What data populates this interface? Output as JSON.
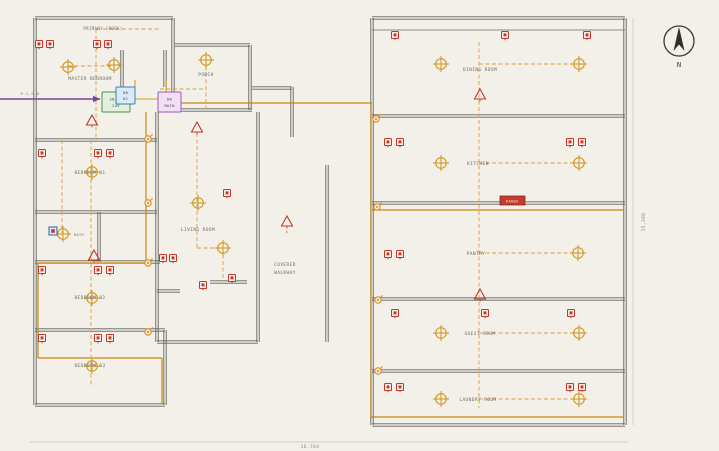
{
  "colors": {
    "background": "#f3f0ea",
    "wall": "#62615a",
    "thin_line": "#6a695f",
    "label": "#6f6e64",
    "dim": "#8a887f",
    "orange": "#c8860d",
    "orange_dash": "#d8a13a",
    "light": "#d39a26",
    "red": "#c0392b",
    "purple": "#8040a0",
    "yellow_conn": "#c8a415",
    "compass": "#3a3a35"
  },
  "room_labels": [
    {
      "text": "PRIMARY (ROOF)",
      "x": 103,
      "y": 30,
      "size": 4
    },
    {
      "text": "MASTER BEDROOM",
      "x": 90,
      "y": 80,
      "size": 4.5
    },
    {
      "text": "PORCH",
      "x": 206,
      "y": 76,
      "size": 4.5
    },
    {
      "text": "BEDROOM 01",
      "x": 90,
      "y": 174,
      "size": 4.5
    },
    {
      "text": "BATH",
      "x": 79,
      "y": 236,
      "size": 3.5
    },
    {
      "text": "BEDROOM 02",
      "x": 90,
      "y": 299,
      "size": 4.5
    },
    {
      "text": "BEDROOM 03",
      "x": 90,
      "y": 367,
      "size": 4.5
    },
    {
      "text": "LIVING ROOM",
      "x": 198,
      "y": 231,
      "size": 4.5
    },
    {
      "text": "COVERED",
      "x": 285,
      "y": 266,
      "size": 4.5
    },
    {
      "text": "WALKWAY",
      "x": 285,
      "y": 274,
      "size": 4.5
    },
    {
      "text": "DINING ROOM",
      "x": 480,
      "y": 71,
      "size": 4.5
    },
    {
      "text": "KITCHEN",
      "x": 478,
      "y": 165,
      "size": 4.5
    },
    {
      "text": "PANTRY",
      "x": 476,
      "y": 255,
      "size": 4.5
    },
    {
      "text": "GUEST ROOM",
      "x": 480,
      "y": 335,
      "size": 4.5
    },
    {
      "text": "LAUNDRY ROOM",
      "x": 478,
      "y": 401,
      "size": 4.5
    }
  ],
  "service_label": {
    "text": "M.S.E.B",
    "x": 30,
    "y": 95,
    "size": 3.8
  },
  "walls": [
    [
      35,
      18,
      173,
      18
    ],
    [
      35,
      18,
      35,
      405
    ],
    [
      173,
      18,
      173,
      112
    ],
    [
      122,
      50,
      122,
      87
    ],
    [
      165,
      50,
      165,
      87
    ],
    [
      175,
      45,
      250,
      45
    ],
    [
      250,
      45,
      250,
      110
    ],
    [
      175,
      110,
      252,
      110
    ],
    [
      35,
      140,
      157,
      140
    ],
    [
      157,
      112,
      157,
      342
    ],
    [
      35,
      212,
      157,
      212
    ],
    [
      99,
      212,
      99,
      262
    ],
    [
      35,
      262,
      160,
      262
    ],
    [
      35,
      330,
      165,
      330
    ],
    [
      165,
      330,
      165,
      405
    ],
    [
      35,
      405,
      165,
      405
    ],
    [
      258,
      112,
      258,
      342
    ],
    [
      157,
      342,
      258,
      342
    ],
    [
      157,
      291,
      180,
      291
    ],
    [
      210,
      282,
      247,
      282
    ],
    [
      292,
      87,
      292,
      137
    ],
    [
      252,
      88,
      292,
      88
    ],
    [
      327,
      165,
      327,
      342
    ],
    [
      372,
      18,
      625,
      18
    ],
    [
      372,
      18,
      372,
      425
    ],
    [
      625,
      18,
      625,
      425
    ],
    [
      372,
      425,
      625,
      425
    ],
    [
      372,
      116,
      625,
      116
    ],
    [
      372,
      203,
      625,
      203
    ],
    [
      372,
      299,
      625,
      299
    ],
    [
      372,
      371,
      625,
      371
    ]
  ],
  "inner_lines": [
    [
      372,
      30,
      625,
      30
    ]
  ],
  "orange_solid": [
    [
      180,
      103,
      372,
      103
    ],
    [
      371,
      103,
      371,
      417
    ],
    [
      371,
      417,
      624,
      417
    ],
    [
      372,
      210,
      624,
      210
    ],
    [
      146,
      112,
      146,
      263
    ],
    [
      38,
      263,
      146,
      263
    ],
    [
      38,
      263,
      38,
      358
    ],
    [
      38,
      358,
      162,
      358
    ],
    [
      162,
      358,
      162,
      404
    ]
  ],
  "yellow_connectors": [
    [
      130,
      99,
      158,
      99
    ],
    [
      135,
      80,
      135,
      87
    ],
    [
      166,
      80,
      166,
      92
    ]
  ],
  "orange_dashed": [
    [
      96,
      29,
      160,
      29
    ],
    [
      96,
      29,
      96,
      140
    ],
    [
      68,
      66,
      114,
      66
    ],
    [
      160,
      89,
      206,
      89
    ],
    [
      62,
      140,
      62,
      233
    ],
    [
      91,
      140,
      91,
      386
    ],
    [
      206,
      60,
      206,
      110
    ],
    [
      197,
      133,
      197,
      248
    ],
    [
      197,
      248,
      223,
      248
    ],
    [
      223,
      248,
      223,
      278
    ],
    [
      479,
      42,
      479,
      408
    ],
    [
      479,
      64,
      579,
      64
    ],
    [
      479,
      163,
      579,
      163
    ],
    [
      479,
      253,
      578,
      253
    ],
    [
      479,
      333,
      579,
      333
    ],
    [
      479,
      399,
      579,
      399
    ]
  ],
  "purple_feeder": {
    "line": [
      0,
      99,
      100,
      99
    ],
    "arrow": [
      [
        100,
        99
      ],
      [
        93,
        95.8
      ],
      [
        93,
        102.2
      ]
    ]
  },
  "outlets": [
    [
      39,
      44
    ],
    [
      50,
      44
    ],
    [
      97,
      44
    ],
    [
      108,
      44
    ],
    [
      42,
      153
    ],
    [
      98,
      153
    ],
    [
      110,
      153
    ],
    [
      42,
      270
    ],
    [
      98,
      270
    ],
    [
      110,
      270
    ],
    [
      42,
      338
    ],
    [
      98,
      338
    ],
    [
      110,
      338
    ],
    [
      227,
      193
    ],
    [
      163,
      258
    ],
    [
      173,
      258
    ],
    [
      203,
      285
    ],
    [
      232,
      278
    ],
    [
      395,
      35
    ],
    [
      505,
      35
    ],
    [
      587,
      35
    ],
    [
      388,
      142
    ],
    [
      400,
      142
    ],
    [
      570,
      142
    ],
    [
      582,
      142
    ],
    [
      388,
      254
    ],
    [
      400,
      254
    ],
    [
      395,
      313
    ],
    [
      485,
      313
    ],
    [
      571,
      313
    ],
    [
      388,
      387
    ],
    [
      400,
      387
    ],
    [
      570,
      387
    ],
    [
      582,
      387
    ]
  ],
  "lights": [
    [
      68,
      67
    ],
    [
      114,
      65
    ],
    [
      206,
      60
    ],
    [
      92,
      172
    ],
    [
      63,
      234
    ],
    [
      92,
      298
    ],
    [
      92,
      366
    ],
    [
      198,
      203
    ],
    [
      223,
      248
    ],
    [
      441,
      64
    ],
    [
      579,
      64
    ],
    [
      441,
      163
    ],
    [
      579,
      163
    ],
    [
      578,
      253
    ],
    [
      441,
      333
    ],
    [
      579,
      333
    ],
    [
      441,
      399
    ],
    [
      579,
      399
    ]
  ],
  "detectors": [
    {
      "x": 92,
      "y": 121,
      "tag": ""
    },
    {
      "x": 197,
      "y": 128,
      "tag": ""
    },
    {
      "x": 287,
      "y": 222,
      "tag": "S"
    },
    {
      "x": 94,
      "y": 256,
      "tag": ""
    },
    {
      "x": 480,
      "y": 95,
      "tag": ""
    },
    {
      "x": 480,
      "y": 295,
      "tag": ""
    }
  ],
  "junctions": [
    [
      148,
      139
    ],
    [
      148,
      203
    ],
    [
      148,
      263
    ],
    [
      148,
      332
    ],
    [
      376,
      119
    ],
    [
      377,
      207
    ],
    [
      378,
      300
    ],
    [
      378,
      371
    ]
  ],
  "panels": [
    {
      "x": 102,
      "y": 92,
      "w": 28,
      "h": 20,
      "fill": "#e3f0dc",
      "stroke": "#4a8f4e",
      "lines": [
        "SB-LA",
        "24V"
      ],
      "name": "panel-sb-la"
    },
    {
      "x": 116,
      "y": 87,
      "w": 19,
      "h": 17,
      "fill": "#d9eaf7",
      "stroke": "#3d7ab8",
      "lines": [
        "DB",
        "02"
      ],
      "name": "panel-db-02"
    },
    {
      "x": 158,
      "y": 92,
      "w": 23,
      "h": 20,
      "fill": "#f2def5",
      "stroke": "#9b59b6",
      "lines": [
        "DB",
        "MAIN"
      ],
      "name": "panel-db-main"
    }
  ],
  "range_outlet": {
    "x": 500,
    "y": 196,
    "w": 25,
    "h": 9,
    "fill": "#c43c2a",
    "stroke": "#8e2a1c",
    "text": "RANGE"
  },
  "bath_fixture": {
    "x": 53,
    "y": 231
  },
  "compass": {
    "cx": 679,
    "cy": 41,
    "r": 15,
    "label": "N"
  },
  "dimensions": {
    "bottom": {
      "text": "16,764",
      "x": 310,
      "y": 448,
      "line": [
        30,
        442,
        628,
        442
      ]
    },
    "right": {
      "text": "15,380",
      "x": 645,
      "y": 222,
      "line": [
        633,
        18,
        633,
        425
      ],
      "rotate": -90
    }
  }
}
